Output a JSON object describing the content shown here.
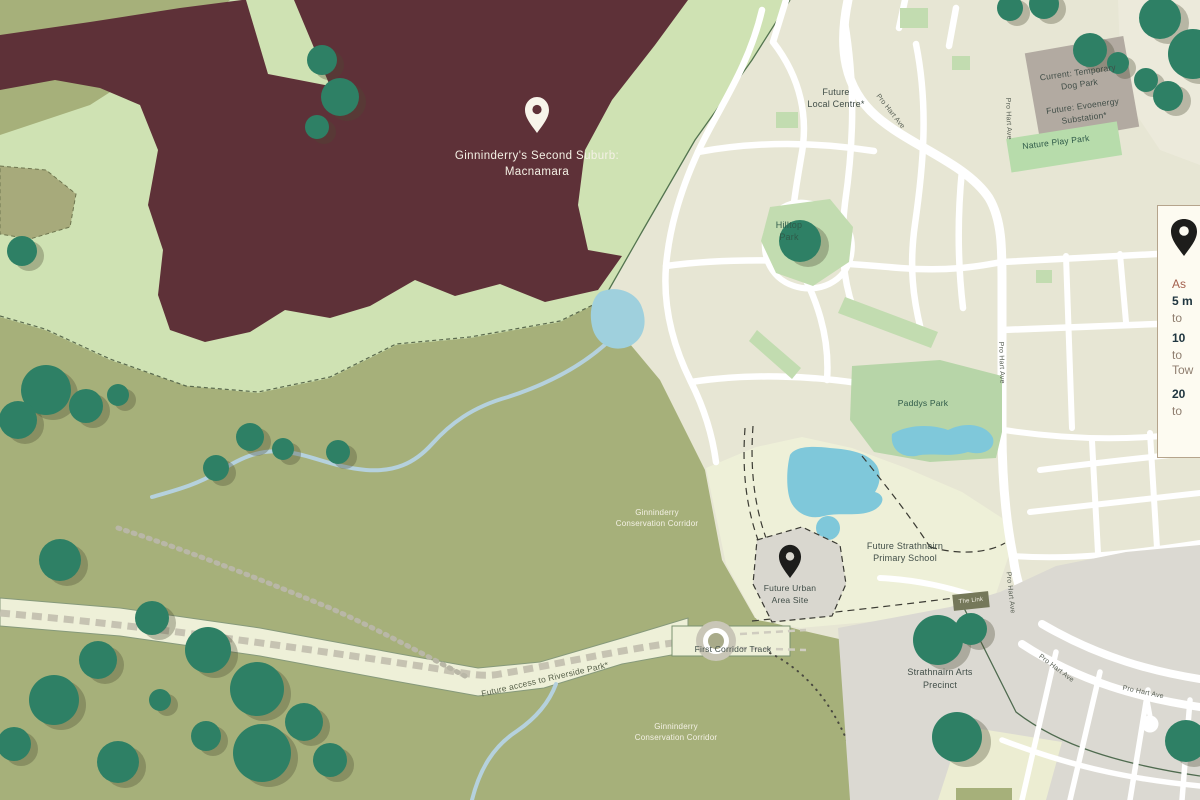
{
  "map": {
    "macnamara": {
      "line1": "Ginninderry's Second Suburb:",
      "line2": "Macnamara"
    },
    "labels": {
      "future_local_centre_line1": "Future",
      "future_local_centre_line2": "Local Centre*",
      "dog_park_line1": "Current: Temporary",
      "dog_park_line2": "Dog Park",
      "dog_park_line3": "Future: Evoenergy",
      "dog_park_line4": "Substation*",
      "nature_play_park": "Nature Play Park",
      "hilltop_park_line1": "Hilltop",
      "hilltop_park_line2": "Park",
      "paddys_park": "Paddys Park",
      "conservation_line1": "Ginninderry",
      "conservation_line2": "Conservation Corridor",
      "school_line1": "Future Strathnairn",
      "school_line2": "Primary School",
      "site_line1": "Future Urban",
      "site_line2": "Area Site",
      "the_link": "The Link",
      "arts_line1": "Strathnairn Arts",
      "arts_line2": "Precinct",
      "first_corridor_track": "First Corridor Track",
      "riverside_access": "Future access to Riverside Park*",
      "pro_hart_ave": "Pro Hart Ave"
    }
  },
  "legend_panel": {
    "lines": [
      {
        "text": "As"
      },
      {
        "text": "5 m"
      },
      {
        "text": "to"
      },
      {
        "text": "10"
      },
      {
        "text": "to"
      },
      {
        "text": "Tow"
      },
      {
        "text": "20"
      },
      {
        "text": "to"
      }
    ]
  },
  "colors": {
    "macnamara_maroon": "#5e3138",
    "conservation_olive": "#a6b07a",
    "mint_green": "#cfe2b3",
    "urban_beige": "#e7e6d4",
    "future_cream": "#eef0d8",
    "park_green": "#c2dcb0",
    "tree_teal": "#2e8065",
    "water_blue": "#7fc8da",
    "precinct_grey": "#dbd9d2",
    "road_white": "#ffffff",
    "panel_cream": "#fdfbf1",
    "accent_rust": "#a4604e"
  }
}
